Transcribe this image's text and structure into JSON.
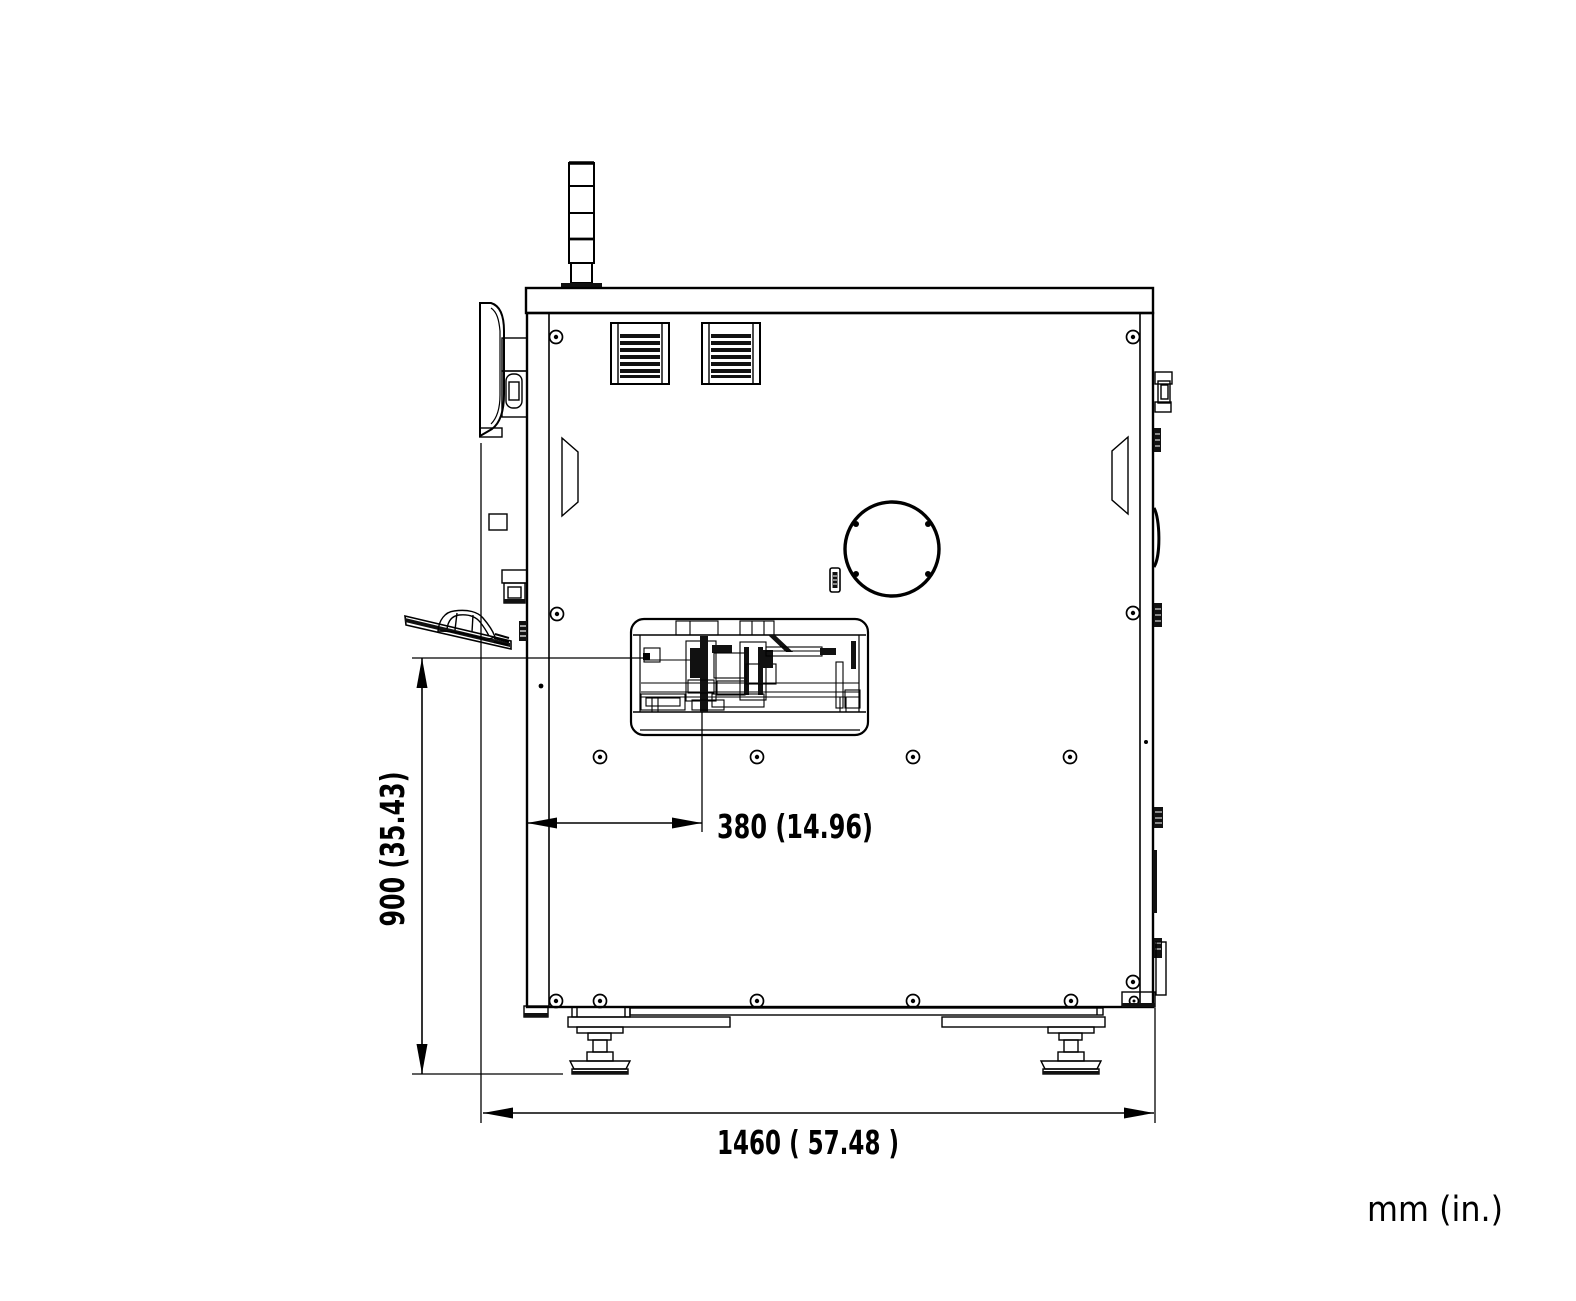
{
  "drawing": {
    "type": "engineering-dimension-drawing",
    "view": "machine side elevation",
    "units_label": "mm (in.)",
    "colors": {
      "ink": "#000000",
      "background": "#ffffff"
    },
    "dimensions": {
      "overall_width": {
        "label": "1460 ( 57.48 )",
        "mm": 1460,
        "inches": 57.48
      },
      "work_height": {
        "label": "900 (35.43)",
        "mm": 900,
        "inches": 35.43
      },
      "head_offset": {
        "label": "380 (14.96)",
        "mm": 380,
        "inches": 14.96
      }
    }
  }
}
